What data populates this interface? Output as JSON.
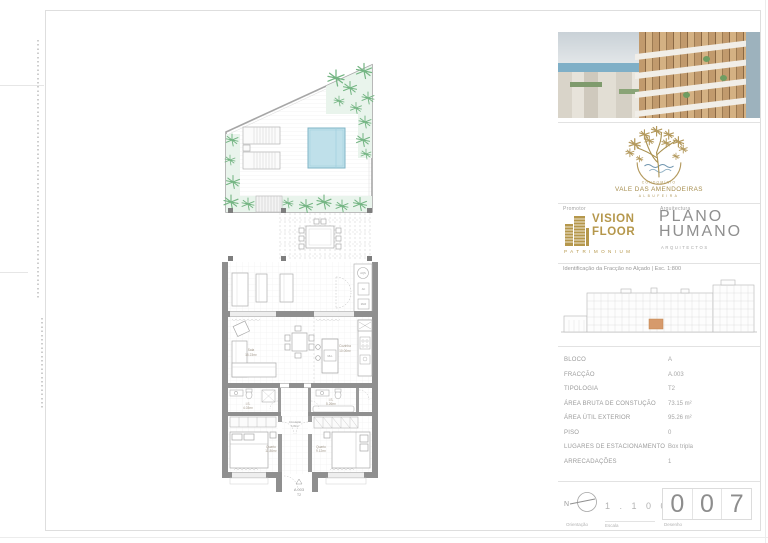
{
  "plan": {
    "rooms": {
      "sala": {
        "name": "Sala",
        "area": "15.23m²"
      },
      "cozinha": {
        "name": "Cozinha",
        "area": "10.00m²"
      },
      "is_1": {
        "name": "I.S.",
        "area": "4.03m²"
      },
      "is_2": {
        "name": "I.S.",
        "area": "5.26m²"
      },
      "quarto_1": {
        "name": "Quarto",
        "area": "11.86m²"
      },
      "quarto_2": {
        "name": "Quarto",
        "area": "9.12m²"
      },
      "circulacao": {
        "name": "Circulação",
        "area": "6.09m²"
      }
    },
    "equipment": {
      "aqs": "AQS",
      "ac": "AC",
      "mlr": "MLR",
      "mll": "MLL"
    },
    "entrance": {
      "unit": "A 003",
      "type": "T2"
    }
  },
  "titleblock": {
    "project": {
      "pre": "CONDOMÍNIO",
      "name": "VALE DAS AMENDOEIRAS",
      "city": "ALBUFEIRA"
    },
    "promoter": {
      "section_label": "Promotor",
      "name_line1": "VISION",
      "name_line2": "FLOOR",
      "subtitle": "PATRIMONIUM"
    },
    "architect": {
      "section_label": "Arquitectura",
      "name_line1": "PLANO",
      "name_line2": "HUMANO",
      "subtitle": "ARQUITECTOS"
    },
    "elevation": {
      "caption": "Identificação da Fracção no Alçado | Esc. 1:800",
      "highlight_color": "#d69a6c"
    },
    "table": {
      "rows": [
        {
          "label": "BLOCO",
          "value": "A"
        },
        {
          "label": "FRACÇÃO",
          "value": "A.003"
        },
        {
          "label": "TIPOLOGIA",
          "value": "T2"
        },
        {
          "label": "ÁREA BRUTA DE CONSTUÇÃO",
          "value": "73.15 m²"
        },
        {
          "label": "ÁREA ÚTIL EXTERIOR",
          "value": "95.26 m²"
        },
        {
          "label": "PISO",
          "value": "0"
        },
        {
          "label": "LUGARES DE ESTACIONAMENTO",
          "value": "Box tripla"
        },
        {
          "label": "ARRECADAÇÕES",
          "value": "1"
        }
      ]
    },
    "footer": {
      "orientation_label": "Orientação",
      "north": "N",
      "scale_label": "Escala",
      "scale_value": "1 . 1 0 0",
      "drawing_label": "Desenho",
      "digits": [
        "0",
        "0",
        "7"
      ]
    },
    "colors": {
      "gold": "#ab9152",
      "logo_gray": "#8f8f8f",
      "plan_green": "#79b98a",
      "pool_blue": "#bfe0ea",
      "highlight": "#d69a6c"
    }
  }
}
